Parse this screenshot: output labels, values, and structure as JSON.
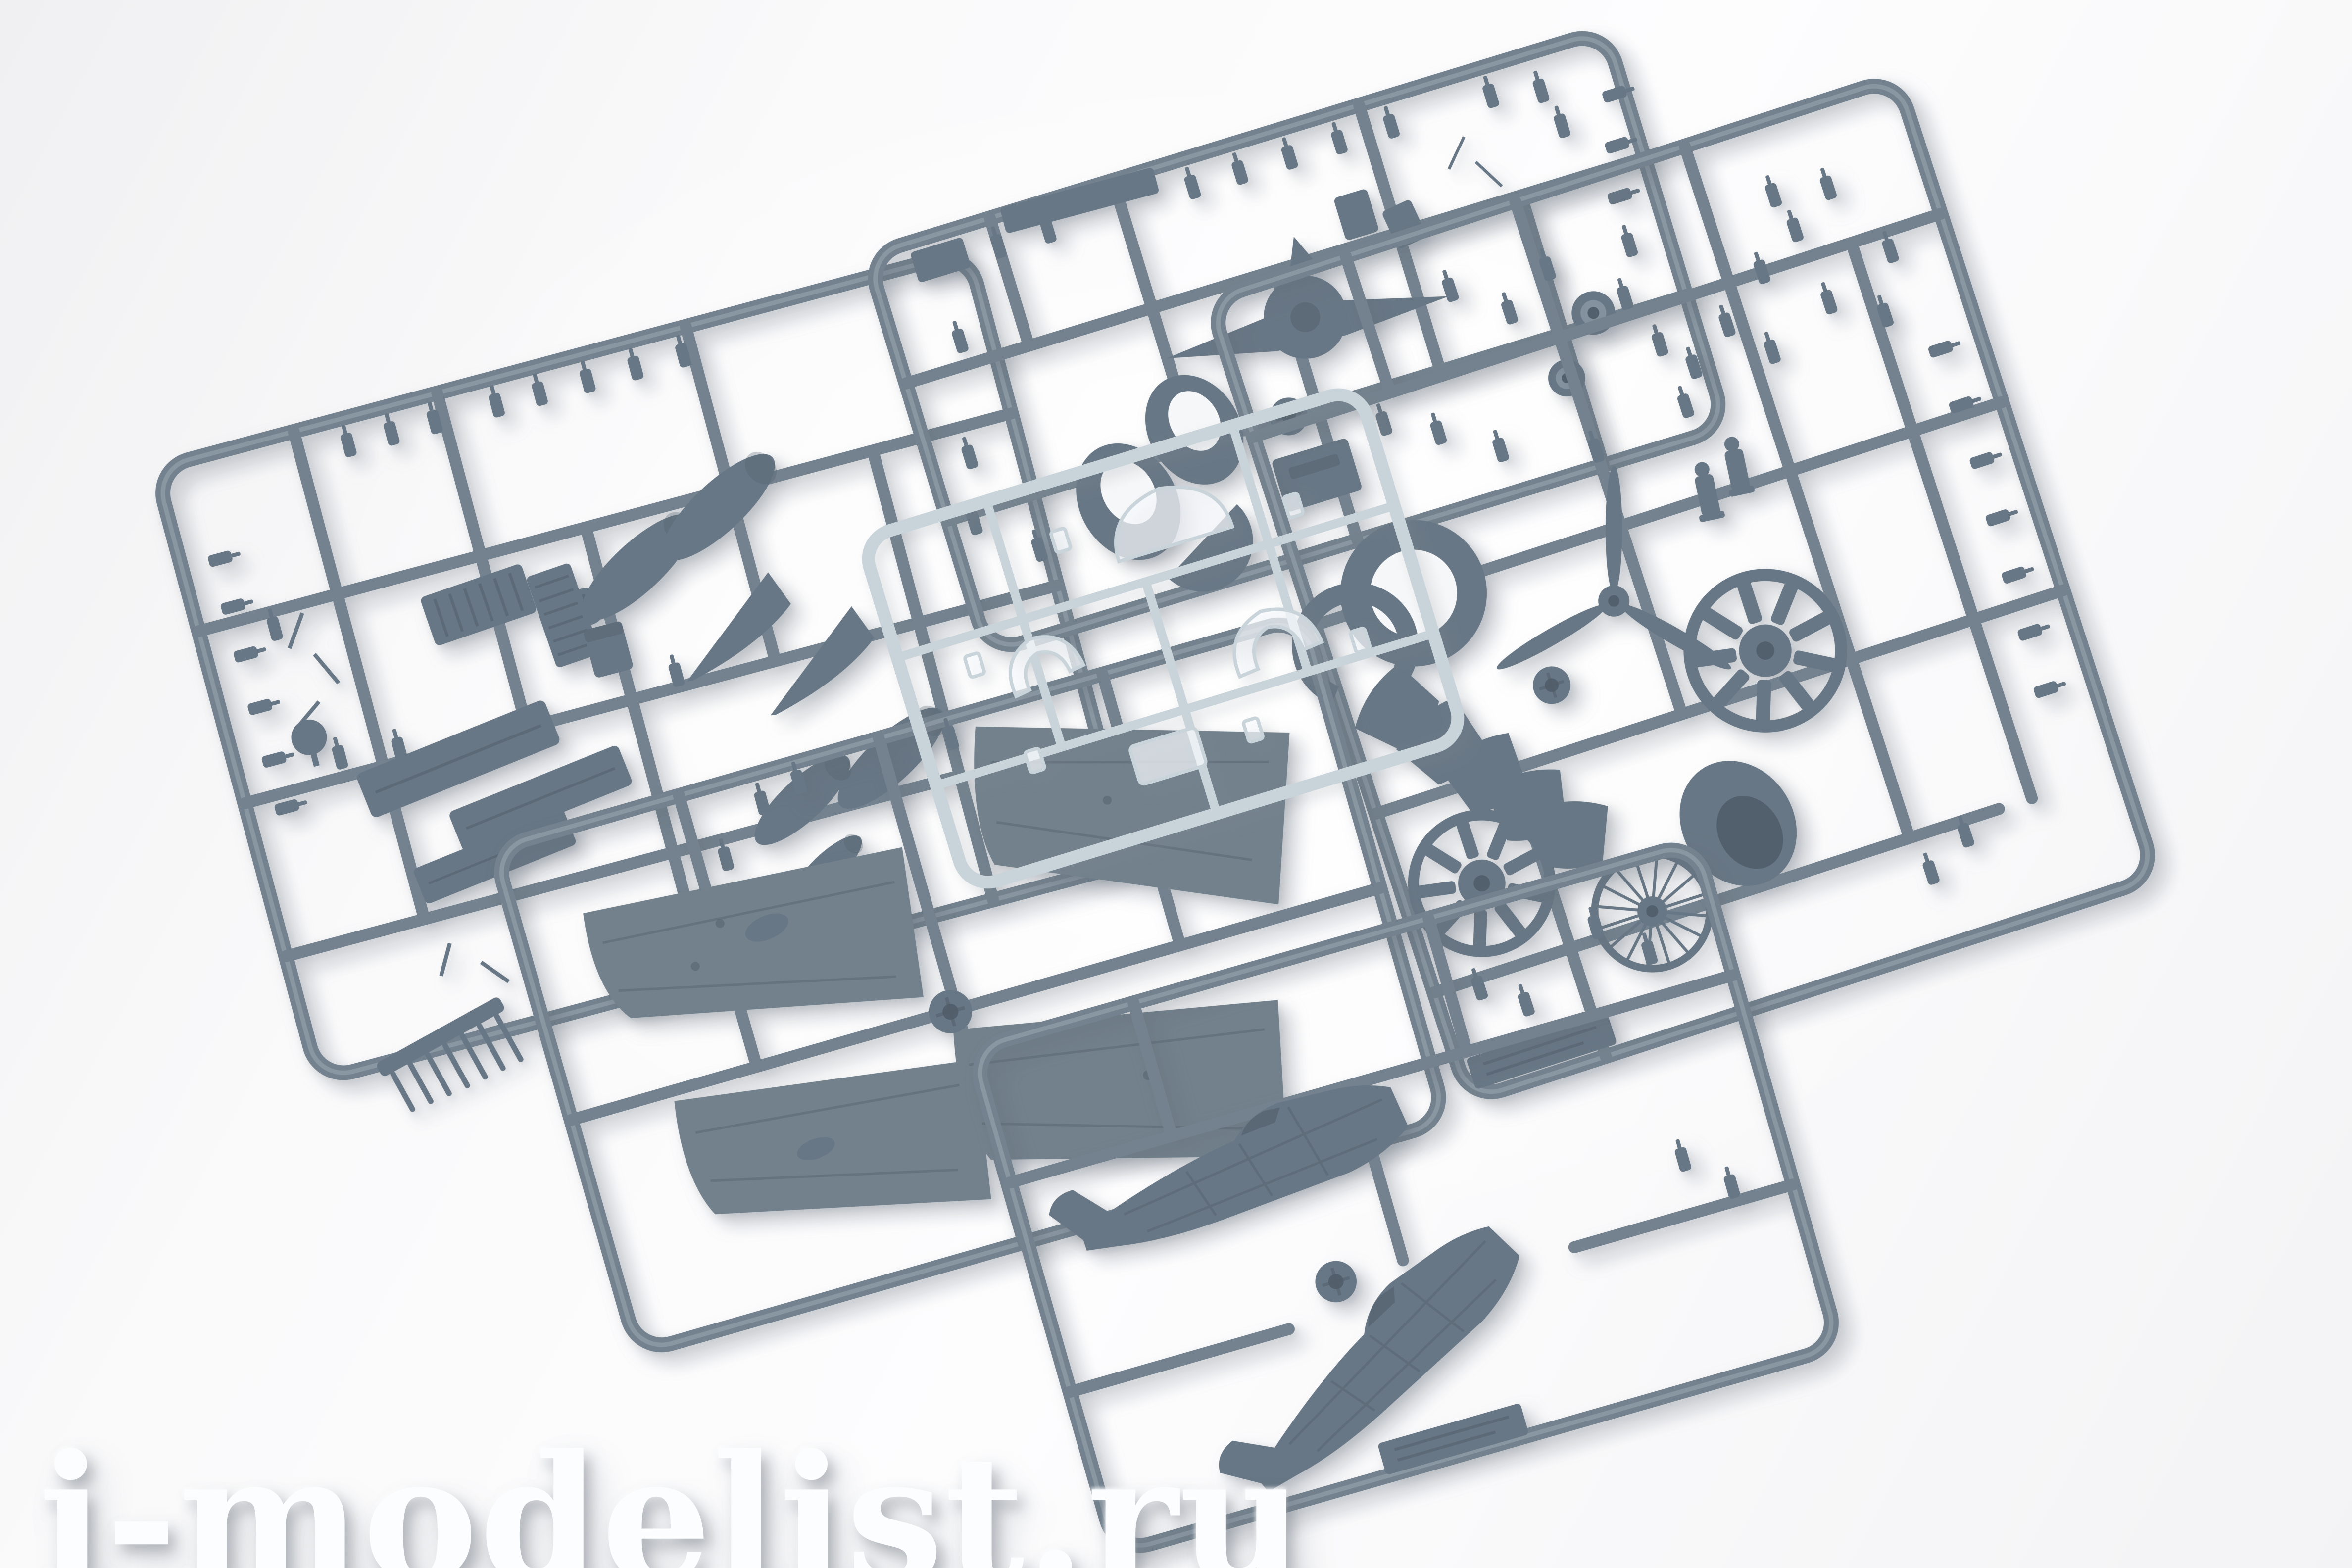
{
  "scene": {
    "description": "Overhead studio photo of six injection-moulded model aircraft kit sprues laid overlapping on a white background: five grey styrene frames with parts and one clear canopy sprue",
    "watermark": "i-modelist.ru"
  },
  "colors": {
    "page_bg_corner": "#f0f0f2",
    "page_bg_mid": "#fafafb",
    "page_bg_light": "#fdfdfe",
    "page_bg_low": "#f3f3f5",
    "runner": "#73828e",
    "runner_hi": "#9fabb6",
    "part": "#687785",
    "part_dark": "#525f6c",
    "part_light": "#83929e",
    "panel": "#72818c",
    "hole": "#f6f7f8",
    "clear_stroke": "#c9d3da",
    "clear_fill": "rgba(248,251,253,0.70)",
    "shadow": "rgba(100,110,122,0.32)",
    "wm": "#fcfdfe",
    "wm_shadow": "rgba(122,129,140,0.50)"
  },
  "sprues": [
    {
      "id": "left-detail-sprue",
      "content": "drop tanks, tail fins, ribbed plates, flap panels, gun barrels, small fittings"
    },
    {
      "id": "top-detail-sprue",
      "content": "tailplane assembly, cockpit bulkheads, wheels, seats, small fittings"
    },
    {
      "id": "engine-sprue",
      "content": "cowling rings, cowl flap segments, propeller, two radial engines, spoked wheel, cowling bowl, crew figures"
    },
    {
      "id": "wing-sprue",
      "content": "four wing half panels around central hub"
    },
    {
      "id": "fuselage-sprue",
      "content": "two fuselage halves and embossed label plate"
    },
    {
      "id": "clear-sprue",
      "content": "canopy hood, windscreen, rear glazing, small clear windows"
    }
  ]
}
